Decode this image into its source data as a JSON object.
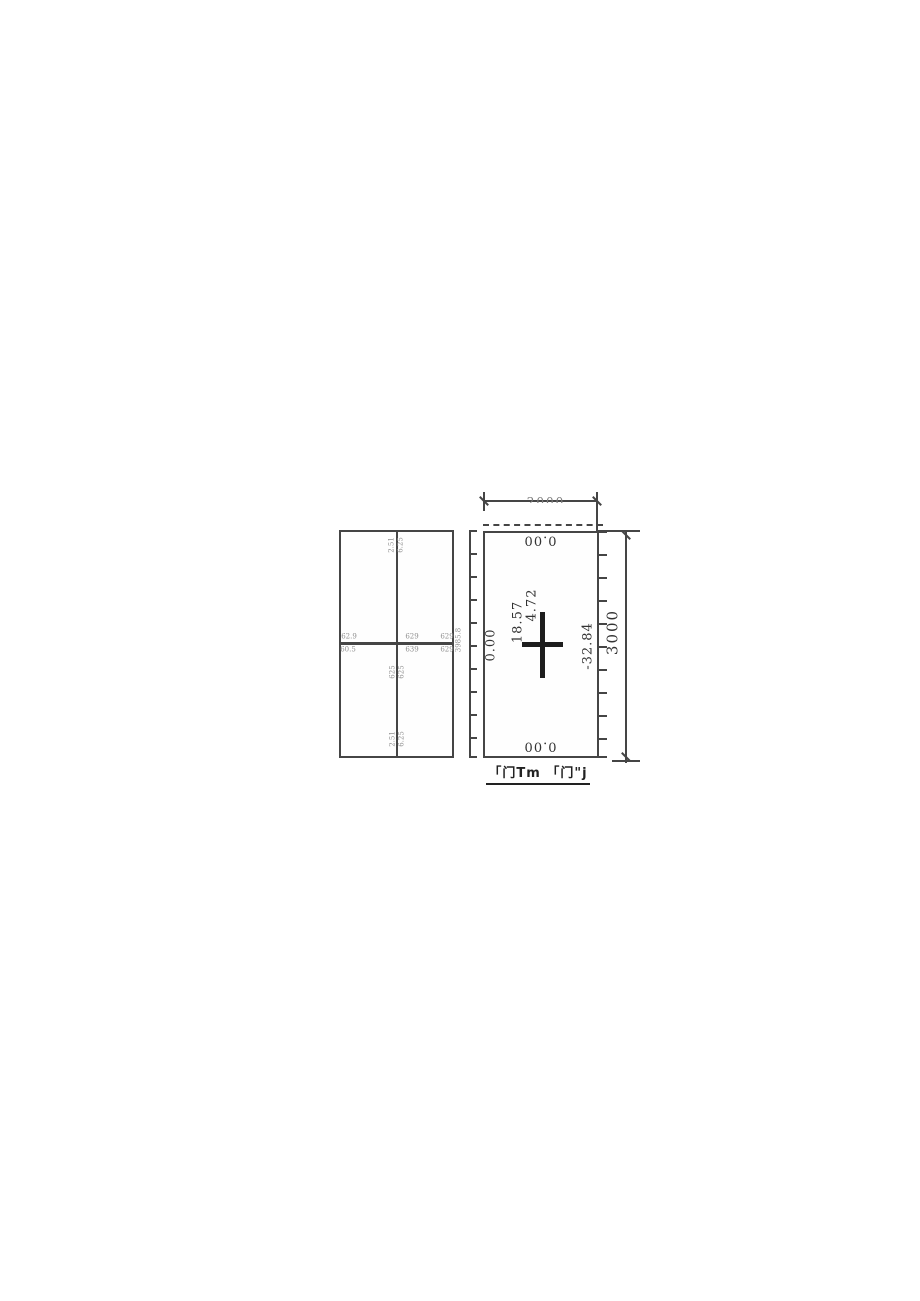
{
  "colors": {
    "line": "#454545",
    "faint": "#8f8f8f",
    "ink": "#1d1d1d"
  },
  "figure": {
    "left_panel": {
      "top_labels": [
        "2.51",
        "6.25"
      ],
      "center_left_labels": [
        "62.9",
        "60.5"
      ],
      "center_mid_labels": [
        "629",
        "639"
      ],
      "center_right_labels": [
        "629",
        "629"
      ],
      "below_center_labels": [
        "625",
        "625"
      ],
      "bottom_labels": [
        "2.51",
        "6.25"
      ]
    },
    "scale_bar": {
      "label": "3985.8"
    },
    "right_panel": {
      "top_value": "0.00",
      "bottom_value": "0.00",
      "left_value": "0.00",
      "right_value": "-32.84",
      "center_values": [
        "18.57",
        "4.72"
      ]
    },
    "dimension_top": "2000",
    "dimension_right": "3000",
    "caption": "「门Tm 「门\"j"
  }
}
